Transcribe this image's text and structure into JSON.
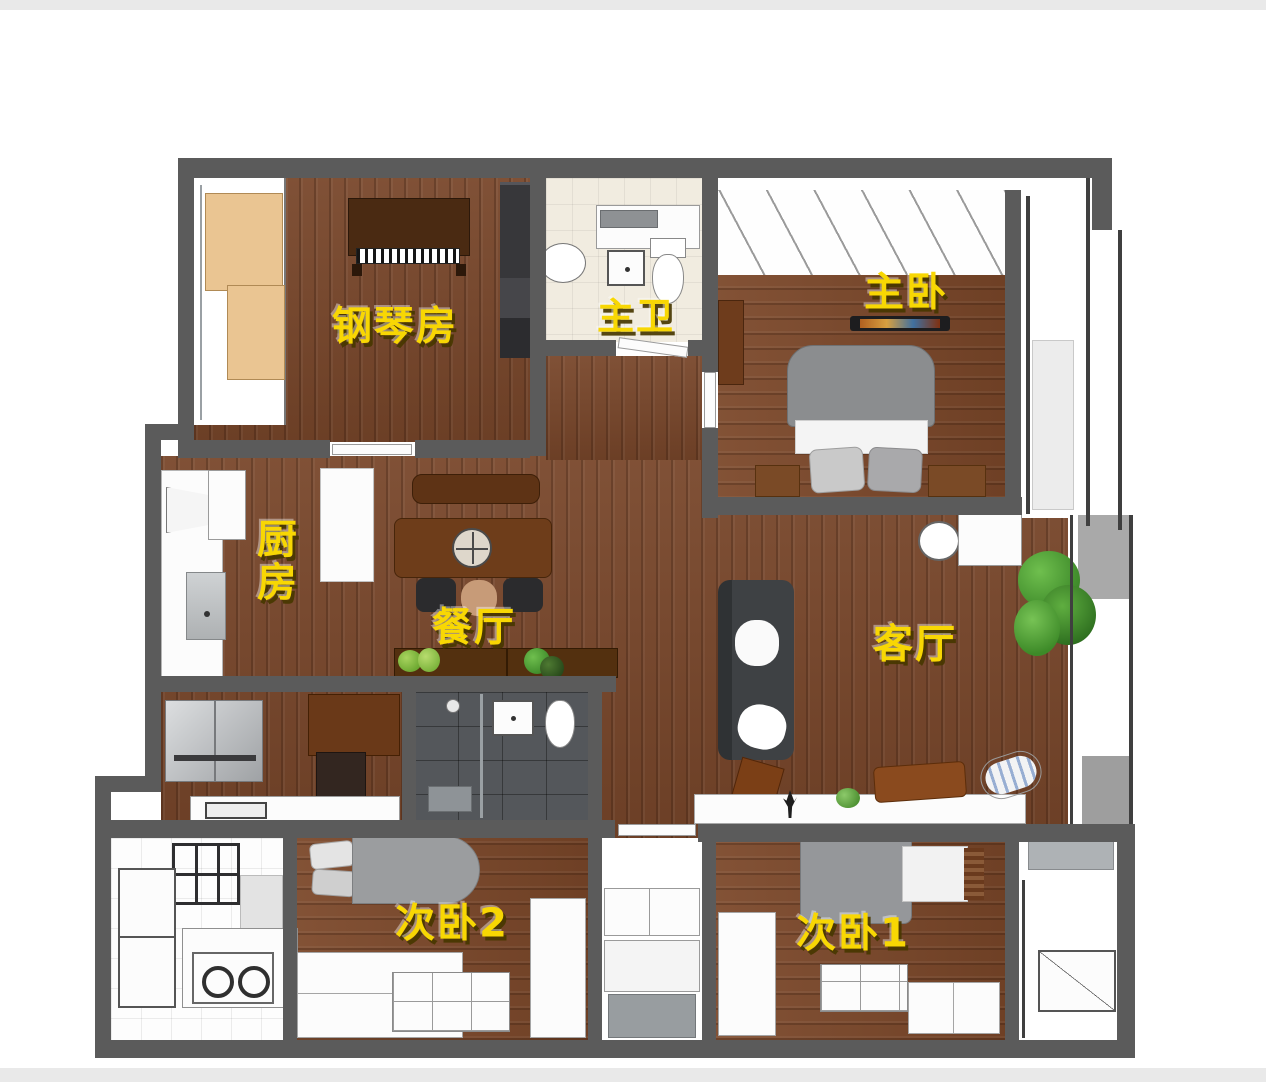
{
  "floorplan": {
    "rooms": {
      "piano": {
        "label": "钢琴房"
      },
      "master_bath": {
        "label": "主卫"
      },
      "master_bedroom": {
        "label": "主卧"
      },
      "kitchen": {
        "label": "厨房"
      },
      "dining": {
        "label": "餐厅"
      },
      "living": {
        "label": "客厅"
      },
      "bedroom2": {
        "label": "次卧2"
      },
      "bedroom1": {
        "label": "次卧1"
      }
    },
    "palette": {
      "label_yellow": "#f8d703",
      "wall_gray": "#5b5b5b",
      "wood_brown": "#78462a",
      "dark_tile": "#54575b",
      "cream_tile": "#f1ece0",
      "plant_green": "#4e9b3c",
      "page_strip_gray": "#e9e9e9"
    }
  }
}
